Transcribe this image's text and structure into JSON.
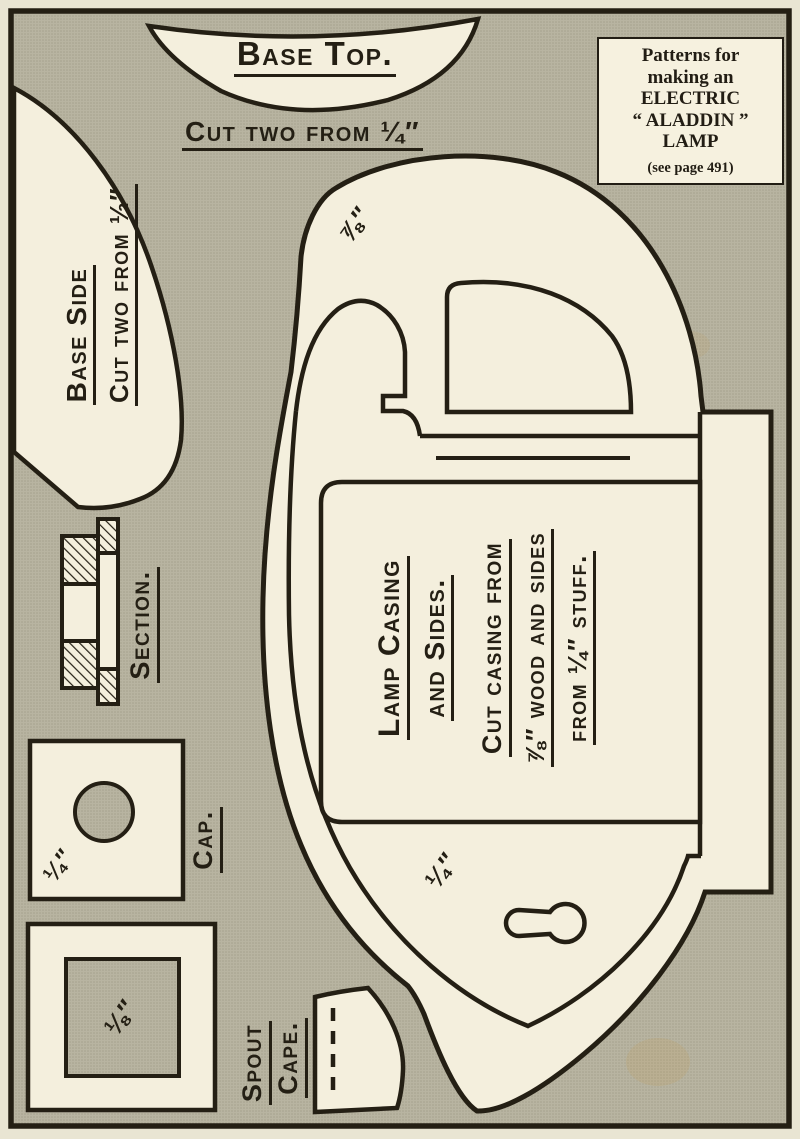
{
  "colors": {
    "paper_margin": "#e9e5d3",
    "halftone_gray": "#b7b3a0",
    "piece_cream": "#f4efdd",
    "ink": "#241f14"
  },
  "corner_box": {
    "lines": [
      "Patterns for",
      "making an",
      "ELECTRIC",
      "“ ALADDIN ”",
      "LAMP"
    ],
    "note": "(see page 491)"
  },
  "labels": {
    "base_top": "Base Top.",
    "base_top_cut": "Cut two from ¼″",
    "base_side": "Base Side",
    "base_side_cut": "Cut two from ½″",
    "section": "Section.",
    "cap": "Cap.",
    "cap_thickness": "¼″",
    "spout_word1": "Spout",
    "spout_word2": "Cape.",
    "spout_thickness": "⅛″",
    "casing_thickness": "⅞″",
    "sides_thickness": "¼″",
    "lamp_title1": "Lamp Casing",
    "lamp_title2": "and Sides.",
    "lamp_note1": "Cut casing from",
    "lamp_note2": "⅞″ wood and sides",
    "lamp_note3": "from ¼″ stuff."
  }
}
